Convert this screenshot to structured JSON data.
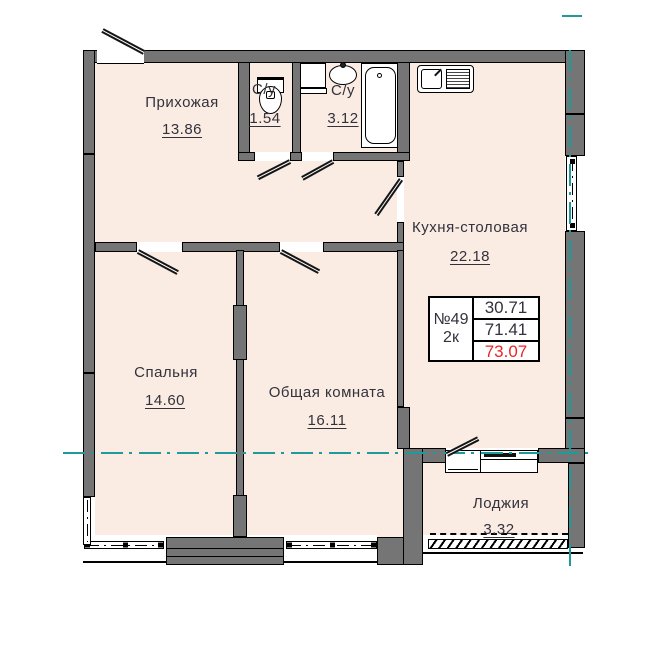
{
  "plan": {
    "title": "apartment-floor-plan",
    "rooms": [
      {
        "id": "hallway",
        "name": "Прихожая",
        "area": "13.86"
      },
      {
        "id": "wc",
        "name": "С/у",
        "area": "1.54"
      },
      {
        "id": "bathroom",
        "name": "С/у",
        "area": "3.12"
      },
      {
        "id": "kitchen",
        "name": "Кухня-столовая",
        "area": "22.18"
      },
      {
        "id": "bedroom",
        "name": "Спальня",
        "area": "14.60"
      },
      {
        "id": "living",
        "name": "Общая комната",
        "area": "16.11"
      },
      {
        "id": "loggia",
        "name": "Лоджия",
        "area": "3.32"
      }
    ],
    "info_box": {
      "number": "№49",
      "type": "2к",
      "values": [
        "30.71",
        "71.41",
        "73.07"
      ]
    },
    "fixtures": [
      "toilet",
      "washing-machine",
      "wash-basin",
      "bathtub",
      "kitchen-sink"
    ],
    "colors": {
      "floor": "#faece3",
      "wall": "#757575",
      "axis": "#1f9a9a",
      "accent_red": "#e8262a",
      "label": "#32323c"
    }
  }
}
